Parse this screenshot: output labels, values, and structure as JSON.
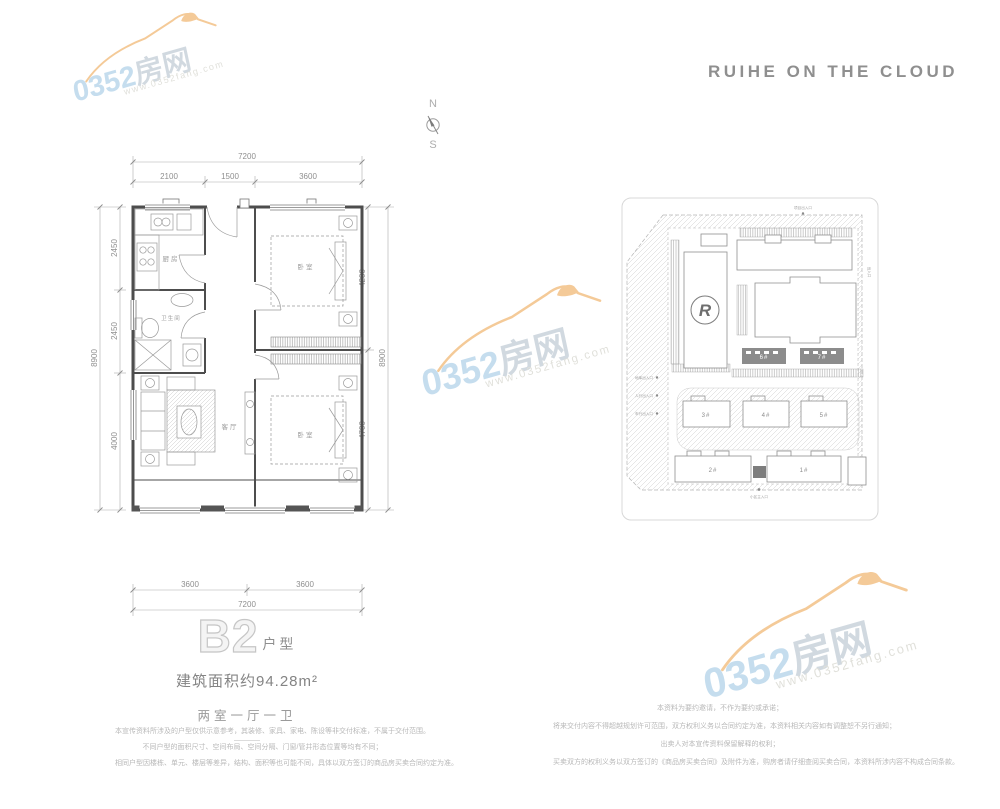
{
  "brand": {
    "logo_text": "RUIHE ON THE CLOUD"
  },
  "compass": {
    "north_label": "N",
    "south_label": "S"
  },
  "watermark": {
    "number": "0352",
    "name": "房网",
    "url": "www.0352fang.com"
  },
  "floorplan": {
    "rooms": {
      "kitchen": "厨房",
      "bathroom": "卫生间",
      "living": "客厅",
      "bedroom_top": "卧室",
      "bedroom_bottom": "卧室"
    },
    "dims": {
      "top_overall": "7200",
      "top_segments": [
        "2100",
        "1500",
        "3600"
      ],
      "left_overall": "8900",
      "left_segments": [
        "2450",
        "2450",
        "4000"
      ],
      "right_overall": "8900",
      "right_segments": [
        "4200",
        "4700"
      ],
      "bottom_overall": "7200",
      "bottom_segments": [
        "3600",
        "3600"
      ]
    }
  },
  "siteplan": {
    "logo_letter": "R",
    "buildings": {
      "b1": "1#",
      "b2": "2#",
      "b3": "3#",
      "b4": "4#",
      "b5": "5#",
      "dark_left": "6#",
      "dark_right": "7#"
    },
    "markers": {
      "top": "项目出入口",
      "left1": "地库出入口",
      "left2": "人行出入口",
      "left3": "车行出入口",
      "bottom": "小区主入口",
      "right": "出入口"
    }
  },
  "unit": {
    "code": "B2",
    "code_suffix": "户型",
    "area": "建筑面积约94.28m²",
    "rooms": "两室一厅一卫"
  },
  "disclaimer_left": {
    "lines": [
      "本宣传资料所涉及的户型仅供示意参考，其装修、家具、家电、陈设等非交付标准，不属于交付范围。",
      "不同户型的面积尺寸、空间布局、空间分隔、门窗/管井形态位置等均有不同；",
      "相同户型因楼栋、单元、楼层等差异，结构、面积等也可能不同，具体以双方签订的商品房买卖合同约定为准。"
    ]
  },
  "disclaimer_right": {
    "lines": [
      "本资料为要约邀请，不作为要约或承诺；",
      "将来交付内容不得超越规划许可范围，双方权利义务以合同约定为准，本资料相关内容如有调整恕不另行通知；",
      "出卖人对本宣传资料保留解释的权利；",
      "买卖双方的权利义务以双方签订的《商品房买卖合同》及附件为准，购房者请仔细查阅买卖合同，本资料所涉内容不构成合同条款。"
    ]
  }
}
